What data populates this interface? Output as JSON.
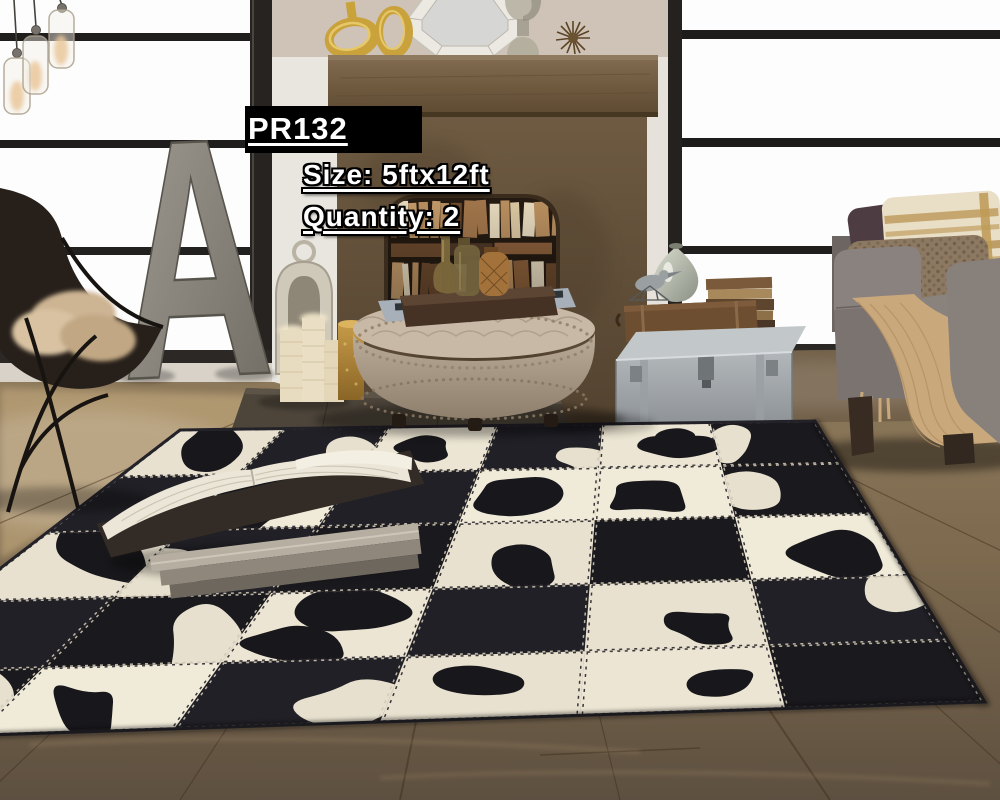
{
  "overlay": {
    "product_code": "PR132",
    "size_label": "Size: 5ftx12ft",
    "quantity_label": "Quantity: 2"
  },
  "scene": {
    "type": "product lifestyle photograph with annotation overlays",
    "room": "rustic industrial living room",
    "objects": [
      "glass pendant lights",
      "black framed factory windows",
      "metal letter A decor",
      "butterfly chair with sheepskin throw",
      "wood mantel fireplace filled with books",
      "gold ring sculptures",
      "octagon mirror",
      "silver urn",
      "sea urchin ornament",
      "silver lantern",
      "pillar candles",
      "hammered gold vase",
      "tufted round ottoman with nailhead trim",
      "serving tray with amber glass bottles",
      "leather suitcase",
      "silver storage trunk",
      "stacked books",
      "bird figurine",
      "mercury glass vase",
      "gray sofa with striped and textured pillows",
      "tan knit throw",
      "black and white cowhide patchwork rug with stitched seams",
      "open book on rug",
      "wood plank floor"
    ],
    "palette": {
      "rug_dark": "#1a191d",
      "rug_light": "#eae3d1",
      "floor_wood": "#8a7355",
      "wall_taupe": "#b9aa9a",
      "mantel_wood": "#6a573f",
      "sofa_gray": "#7e7672",
      "throw_tan": "#c9a97c",
      "accent_gold": "#c9a23c",
      "overlay_box": "#000000",
      "overlay_text": "#ffffff"
    }
  },
  "rug": {
    "type": "cowhide patchwork",
    "grid": [
      [
        "W1",
        "B1",
        "W1",
        "B1",
        "W2",
        "B1"
      ],
      [
        "B0",
        "W2",
        "B0",
        "W1",
        "W1",
        "B1"
      ],
      [
        "W1",
        "B1",
        "B0",
        "W1",
        "B0",
        "W1"
      ],
      [
        "B0",
        "B1",
        "W2",
        "B0",
        "W1",
        "B1"
      ],
      [
        "B1",
        "W1",
        "B1",
        "W1",
        "W1",
        "B0"
      ]
    ]
  }
}
